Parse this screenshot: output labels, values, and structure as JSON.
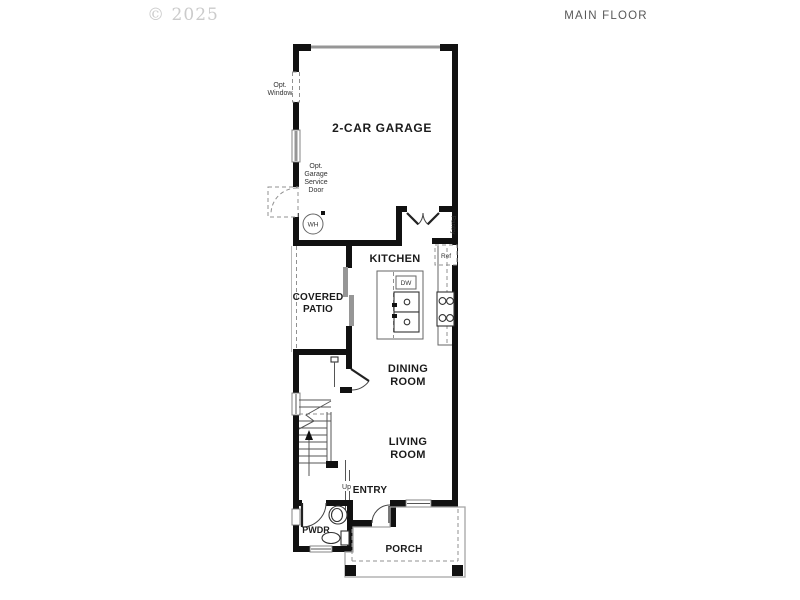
{
  "header": {
    "copyright": "© 2025",
    "title": "MAIN FLOOR"
  },
  "rooms": {
    "garage": "2-CAR GARAGE",
    "kitchen": "KITCHEN",
    "covered_patio": [
      "COVERED",
      "PATIO"
    ],
    "dining": [
      "DINING",
      "ROOM"
    ],
    "living": [
      "LIVING",
      "ROOM"
    ],
    "entry": "ENTRY",
    "pwdr": "PWDR",
    "porch": "PORCH",
    "pantry": "Pantry"
  },
  "labels": {
    "opt_window": [
      "Opt.",
      "Window"
    ],
    "opt_service_door": [
      "Opt.",
      "Garage",
      "Service",
      "Door"
    ],
    "water_heater": "WH",
    "refrigerator": "Ref",
    "dishwasher": "DW",
    "stairs_up": "Up"
  },
  "colors": {
    "wall": "#111111",
    "thin_line": "#555555",
    "dashed_line": "#909090",
    "window_glass": "#969696",
    "label_text": "#1b1b1b",
    "title_text": "#585858",
    "copyright_text": "#cbcbcb",
    "background": "#ffffff"
  }
}
